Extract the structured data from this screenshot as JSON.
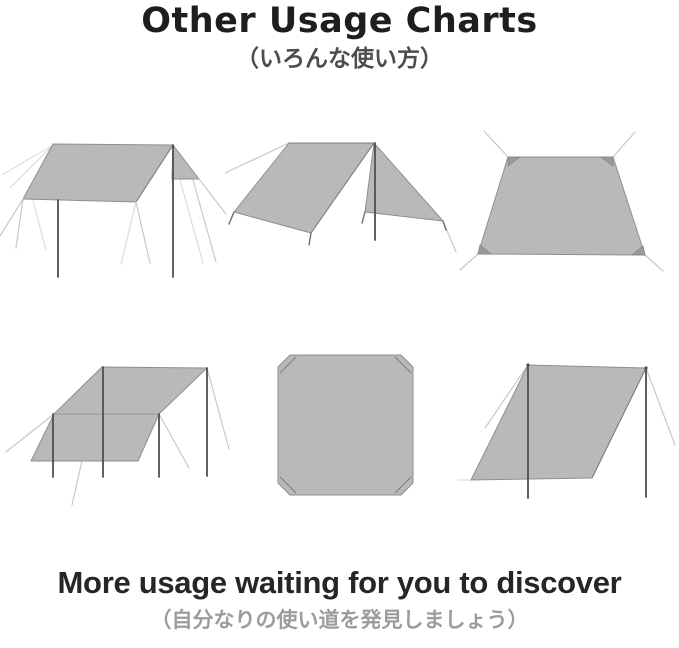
{
  "header": {
    "title": "Other Usage Charts",
    "subtitle_ja": "（いろんな使い方）"
  },
  "footer": {
    "heading": "More usage waiting for you to discover",
    "subheading_ja": "（自分なりの使い道を発見しましょう）"
  },
  "diagrams": [
    {
      "id": "flat-roof-tarp-diagram",
      "label": "Flat canopy pitch with two poles and guy lines"
    },
    {
      "id": "a-frame-tarp-diagram",
      "label": "A-frame ridge pitch with center pole"
    },
    {
      "id": "ground-sheet-diagram",
      "label": "Tarp staked flat on the ground"
    },
    {
      "id": "sloped-awning-tarp-diagram",
      "label": "Stepped awning pitch with four poles"
    },
    {
      "id": "flat-square-tarp-diagram",
      "label": "Square tarp laid flat, top view"
    },
    {
      "id": "wind-break-tarp-diagram",
      "label": "Upright wind-break pitch with two poles"
    }
  ],
  "colors": {
    "background": "#ffffff",
    "title_text": "#1e1e1e",
    "subtitle_text": "#4d4d4d",
    "footer_heading_text": "#262626",
    "footer_subheading_text": "#9c9c9c",
    "tarp_fill": "#b9b9b9",
    "tarp_outline": "#8f8f8f",
    "pole": "#4f4f4f",
    "guy_line": "#c8c8c8"
  }
}
